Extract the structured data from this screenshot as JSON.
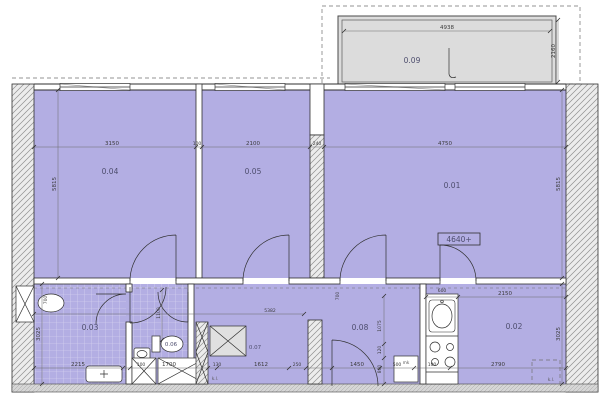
{
  "plan": {
    "rooms": {
      "r01": "0.01",
      "r02": "0.02",
      "r03": "0.03",
      "r04": "0.04",
      "r05": "0.05",
      "r06": "0.06",
      "r07": "0.07",
      "r08": "0.08",
      "r09": "0.09"
    },
    "elevation_marker": "4640+",
    "fixture_labels": {
      "fridge": "mk",
      "washer_mark": "k.l.",
      "shaft_mark": "k.l."
    },
    "dims": {
      "top": [
        "3150",
        "100",
        "2100",
        "240",
        "4750"
      ],
      "balcony_width": "4938",
      "balcony_depth": "2160",
      "kitchen": [
        "600",
        "2150"
      ],
      "corridor": "5382",
      "bottom": [
        "2215",
        "100",
        "1700",
        "130",
        "1612",
        "250",
        "1450",
        "500",
        "100",
        "2790"
      ],
      "left": [
        "5815",
        "3025"
      ],
      "right": [
        "5815",
        "3025"
      ],
      "small_vertical": [
        "700",
        "1100",
        "700",
        "1075",
        "120",
        "800"
      ]
    },
    "colors": {
      "room_fill": "#b3aee3",
      "balcony_fill": "#dcdcdc",
      "wall_hatch_bg": "#ececec",
      "line": "#2f2f2f"
    }
  }
}
